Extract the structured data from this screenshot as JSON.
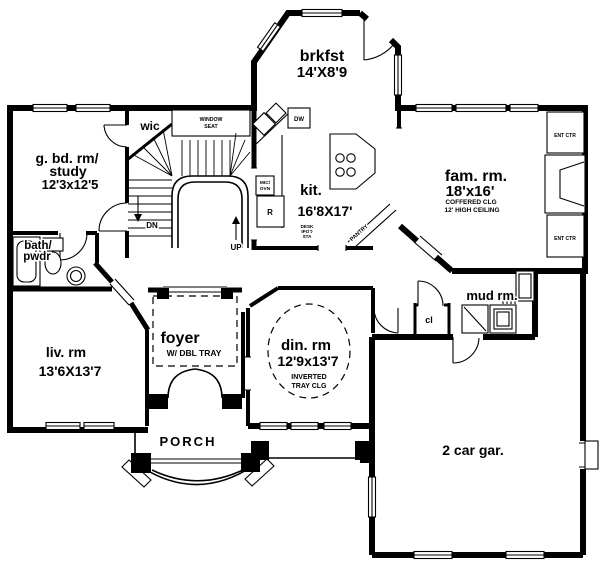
{
  "rooms": {
    "brkfst": {
      "name": "brkfst",
      "dims": "14'X8'9"
    },
    "guest_study": {
      "line1": "g. bd. rm/",
      "line2": "study",
      "dims": "12'3x12'5"
    },
    "wic": {
      "name": "wic"
    },
    "window_seat": {
      "line1": "WINDOW",
      "line2": "SEAT"
    },
    "kitchen": {
      "name": "kit.",
      "dims": "16'8X17'"
    },
    "family": {
      "name": "fam. rm.",
      "dims": "18'x16'",
      "note1": "COFFERED CLG",
      "note2": "12' HIGH CEILING"
    },
    "bath": {
      "line1": "bath/",
      "line2": "pwdr"
    },
    "living": {
      "name": "liv. rm",
      "dims": "13'6X13'7"
    },
    "foyer": {
      "name": "foyer",
      "note": "W/ DBL TRAY"
    },
    "dining": {
      "name": "din. rm",
      "dims": "12'9x13'7",
      "note1": "INVERTED",
      "note2": "TRAY CLG"
    },
    "mud": {
      "name": "mud rm."
    },
    "closet": {
      "name": "cl"
    },
    "porch": {
      "name": "PORCH"
    },
    "garage": {
      "name": "2 car gar."
    }
  },
  "fixtures": {
    "dn": "DN",
    "up": "UP",
    "dw": "DW",
    "fridge": "R",
    "mic_line1": "MIC/",
    "mic_line2": "OVN",
    "desk_line1": "DESK",
    "desk_line2": "IPOD",
    "desk_line3": "STA",
    "pantry": "PANTRY",
    "ent_ctr_top": "ENT CTR",
    "ent_ctr_bottom": "ENT CTR"
  },
  "colors": {
    "ink": "#000000",
    "paper": "#ffffff"
  }
}
